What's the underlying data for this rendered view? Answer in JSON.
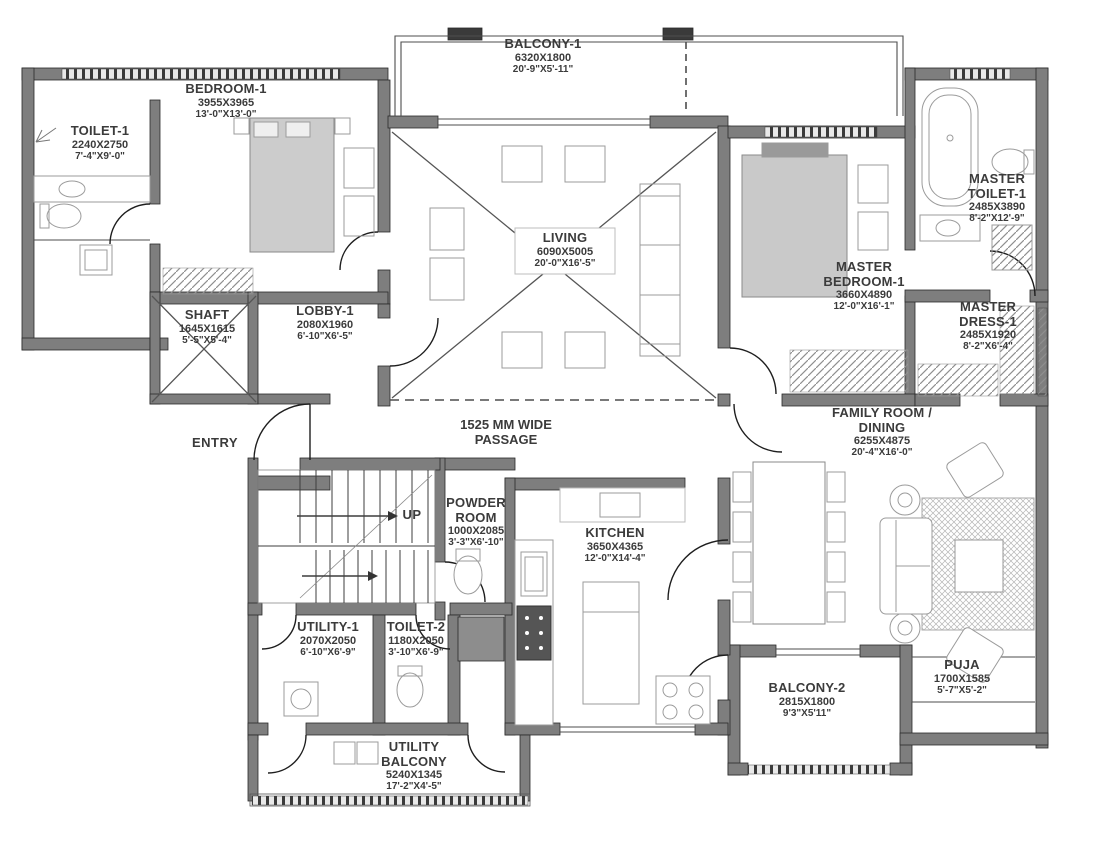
{
  "drawing_title": "Apartment floor plan",
  "colors": {
    "wall": "#7e7e7e",
    "line": "#4d4d4d",
    "text": "#3b3b3b",
    "furniture": "#9b9b9b"
  },
  "rooms": {
    "balcony1": {
      "name": "BALCONY-1",
      "mm": "6320X1800",
      "ft": "20'-9\"X5'-11\""
    },
    "bedroom1": {
      "name": "BEDROOM-1",
      "mm": "3955X3965",
      "ft": "13'-0\"X13'-0\""
    },
    "toilet1": {
      "name": "TOILET-1",
      "mm": "2240X2750",
      "ft": "7'-4\"X9'-0\""
    },
    "living": {
      "name": "LIVING",
      "mm": "6090X5005",
      "ft": "20'-0\"X16'-5\""
    },
    "master_toilet1": {
      "name": "MASTER TOILET-1",
      "mm": "2485X3890",
      "ft": "8'-2\"X12'-9\""
    },
    "master_bedroom1": {
      "name": "MASTER BEDROOM-1",
      "mm": "3660X4890",
      "ft": "12'-0\"X16'-1\""
    },
    "master_dress1": {
      "name": "MASTER DRESS-1",
      "mm": "2485X1920",
      "ft": "8'-2\"X6'-4\""
    },
    "shaft": {
      "name": "SHAFT",
      "mm": "1645X1615",
      "ft": "5'-5\"X5'-4\""
    },
    "lobby1": {
      "name": "LOBBY-1",
      "mm": "2080X1960",
      "ft": "6'-10\"X6'-5\""
    },
    "family_dining": {
      "name": "FAMILY ROOM / DINING",
      "mm": "6255X4875",
      "ft": "20'-4\"X16'-0\""
    },
    "powder_room": {
      "name": "POWDER ROOM",
      "mm": "1000X2085",
      "ft": "3'-3\"X6'-10\""
    },
    "kitchen": {
      "name": "KITCHEN",
      "mm": "3650X4365",
      "ft": "12'-0\"X14'-4\""
    },
    "utility1": {
      "name": "UTILITY-1",
      "mm": "2070X2050",
      "ft": "6'-10\"X6'-9\""
    },
    "toilet2": {
      "name": "TOILET-2",
      "mm": "1180X2050",
      "ft": "3'-10\"X6'-9\""
    },
    "utility_balcony": {
      "name": "UTILITY BALCONY",
      "mm": "5240X1345",
      "ft": "17'-2\"X4'-5\""
    },
    "balcony2": {
      "name": "BALCONY-2",
      "mm": "2815X1800",
      "ft": "9'3\"X5'11\""
    },
    "puja": {
      "name": "PUJA",
      "mm": "1700X1585",
      "ft": "5'-7\"X5'-2\""
    }
  },
  "labels": {
    "passage": "1525 MM WIDE PASSAGE",
    "entry": "ENTRY",
    "up": "UP"
  }
}
